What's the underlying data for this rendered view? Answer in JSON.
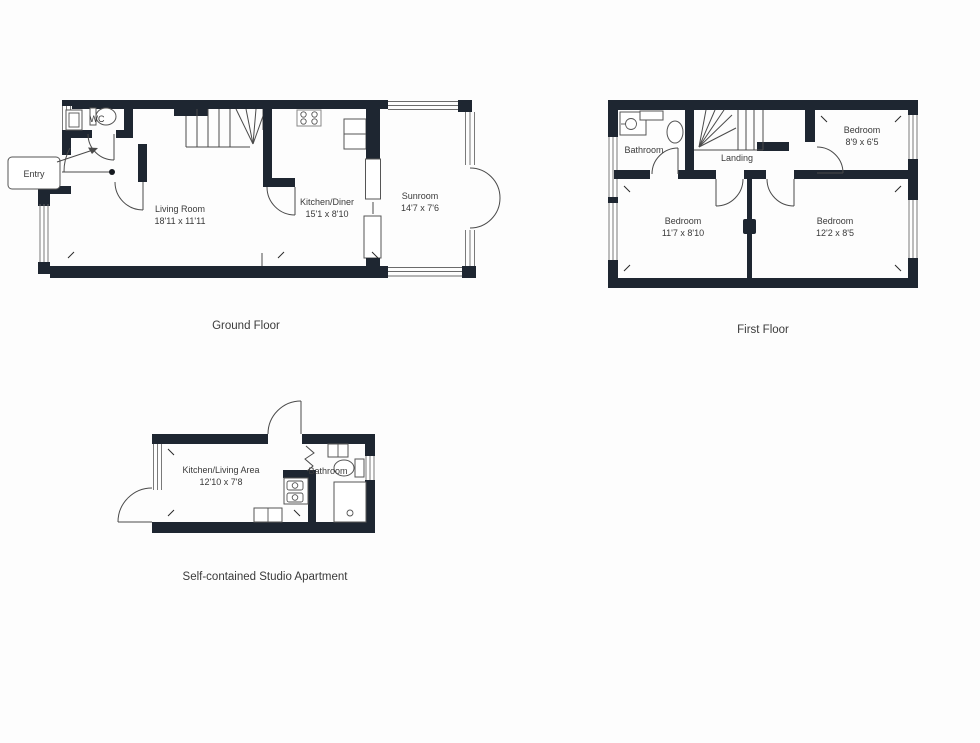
{
  "colors": {
    "wall": "#1e2631",
    "line": "#4a4a4a",
    "text": "#3a3a3a",
    "background": "#fdfdfd"
  },
  "ground": {
    "caption": "Ground Floor",
    "wc": "WC",
    "entry": "Entry",
    "living_name": "Living Room",
    "living_dims": "18'11 x 11'11",
    "kitchen_name": "Kitchen/Diner",
    "kitchen_dims": "15'1 x 8'10",
    "sunroom_name": "Sunroom",
    "sunroom_dims": "14'7 x 7'6"
  },
  "first": {
    "caption": "First Floor",
    "bathroom": "Bathroom",
    "landing": "Landing",
    "bed1_name": "Bedroom",
    "bed1_dims": "8'9 x 6'5",
    "bed2_name": "Bedroom",
    "bed2_dims": "11'7 x 8'10",
    "bed3_name": "Bedroom",
    "bed3_dims": "12'2 x 8'5"
  },
  "studio": {
    "caption": "Self-contained Studio Apartment",
    "kitchen_name": "Kitchen/Living Area",
    "kitchen_dims": "12'10 x 7'8",
    "bathroom": "Bathroom"
  }
}
